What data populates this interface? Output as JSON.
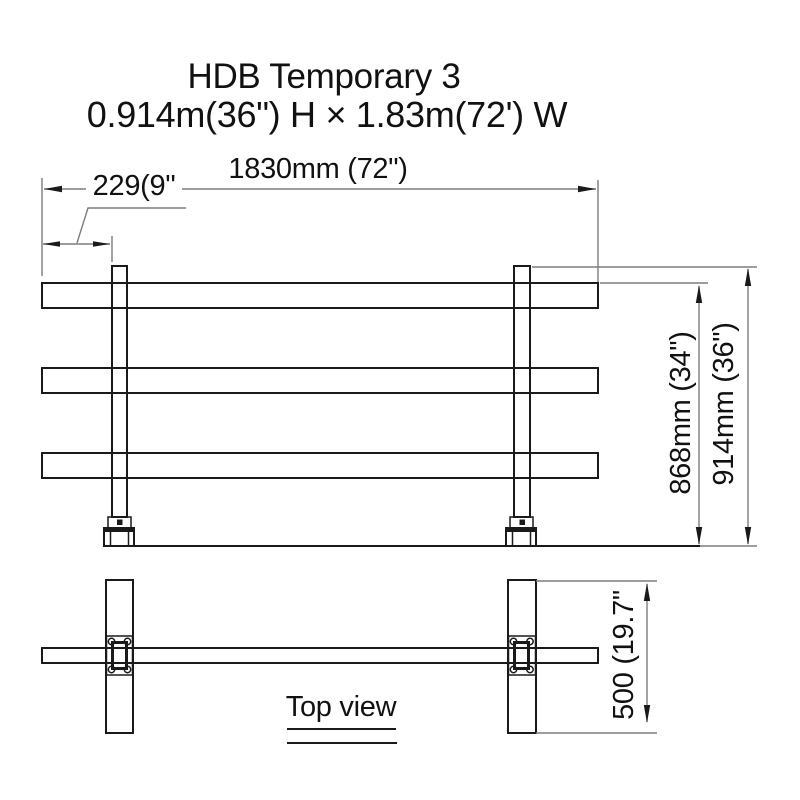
{
  "colors": {
    "bg": "#ffffff",
    "line": "#1a1a1a",
    "dim": "#7d7d7d",
    "text": "#111111"
  },
  "header": {
    "title": "HDB Temporary 3",
    "subtitle": "0.914m(36\") H × 1.83m(72') W"
  },
  "front_view": {
    "width_dim_label": "1830mm (72\")",
    "post_offset_dim_label": "229(9\"",
    "rail_height_dim_label": "868mm (34\")",
    "overall_height_dim_label": "914mm (36\")"
  },
  "top_view": {
    "caption": "Top view",
    "depth_dim_label": "500 (19.7\""
  }
}
